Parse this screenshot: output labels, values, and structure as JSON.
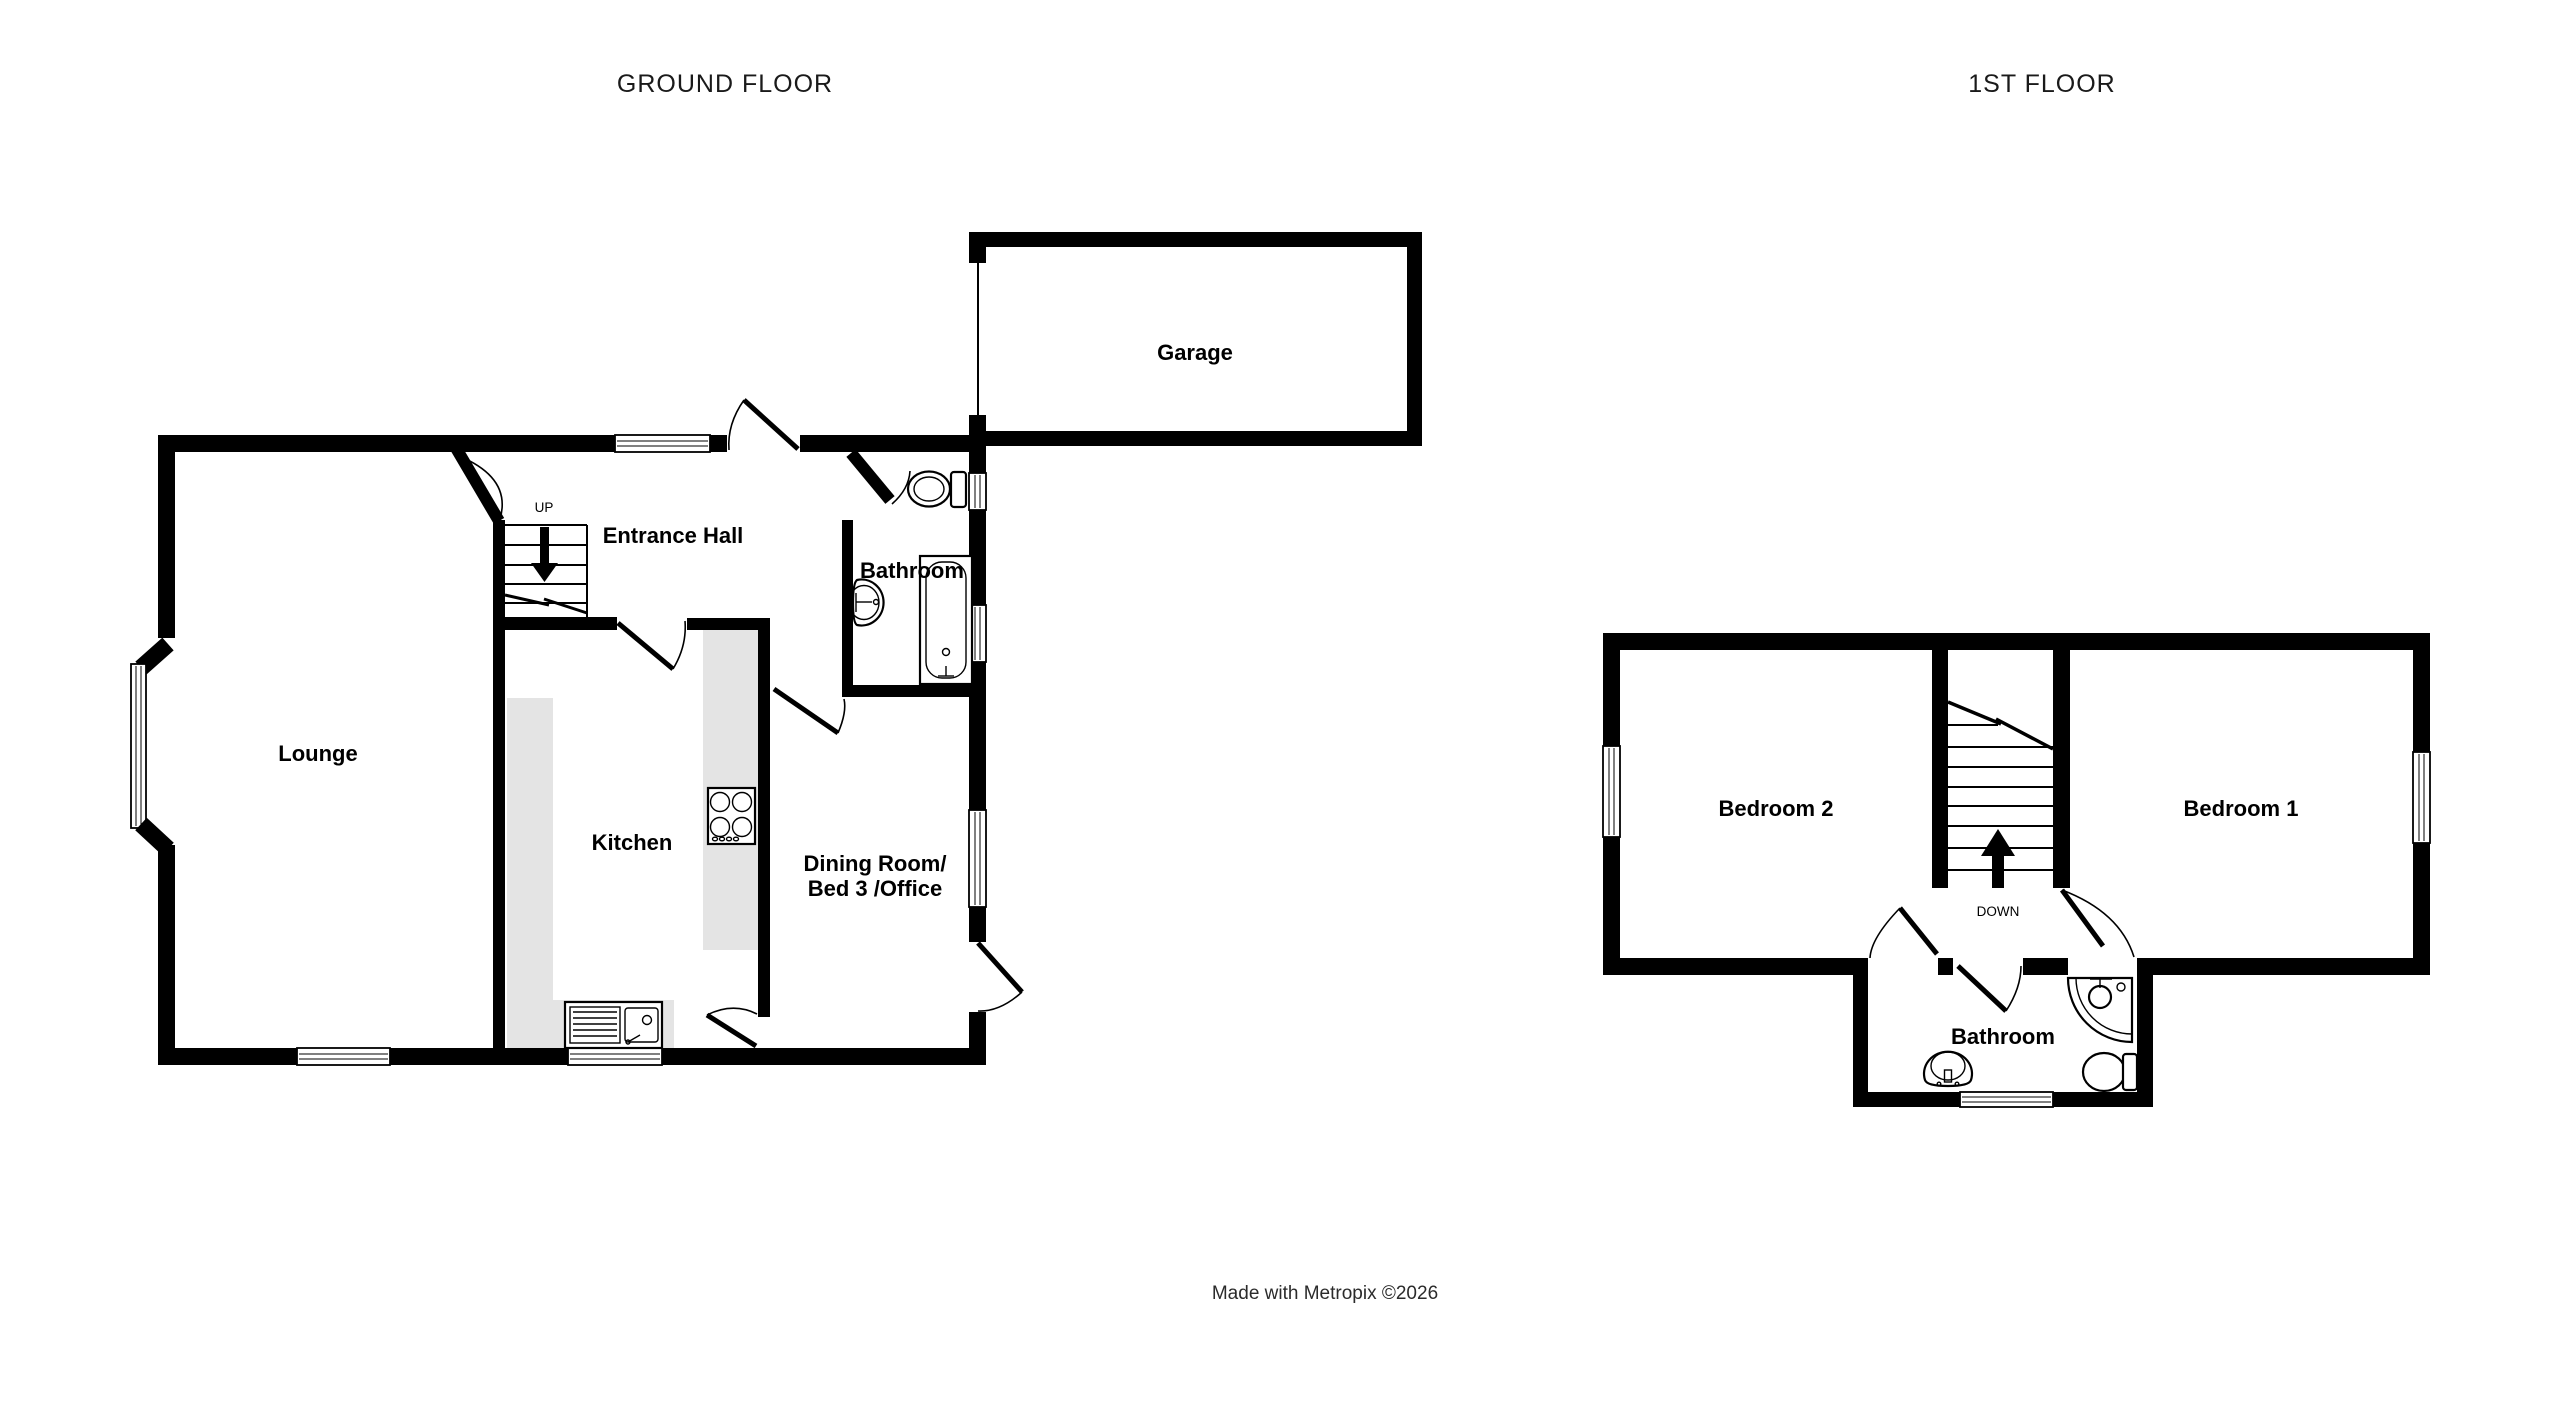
{
  "page": {
    "ground_floor_title": "GROUND FLOOR",
    "first_floor_title": "1ST FLOOR",
    "credit": "Made with Metropix ©2026"
  },
  "ground_floor": {
    "rooms": {
      "lounge": "Lounge",
      "entrance_hall": "Entrance Hall",
      "kitchen": "Kitchen",
      "bathroom": "Bathroom",
      "dining_line1": "Dining Room/",
      "dining_line2": "Bed 3 /Office",
      "garage": "Garage"
    },
    "stairs_label": "UP"
  },
  "first_floor": {
    "rooms": {
      "bedroom1": "Bedroom 1",
      "bedroom2": "Bedroom 2",
      "bathroom": "Bathroom"
    },
    "stairs_label": "DOWN"
  },
  "colors": {
    "wall": "#000000",
    "counter": "#e4e4e4",
    "text": "#000000",
    "title": "#1a1a1a"
  }
}
